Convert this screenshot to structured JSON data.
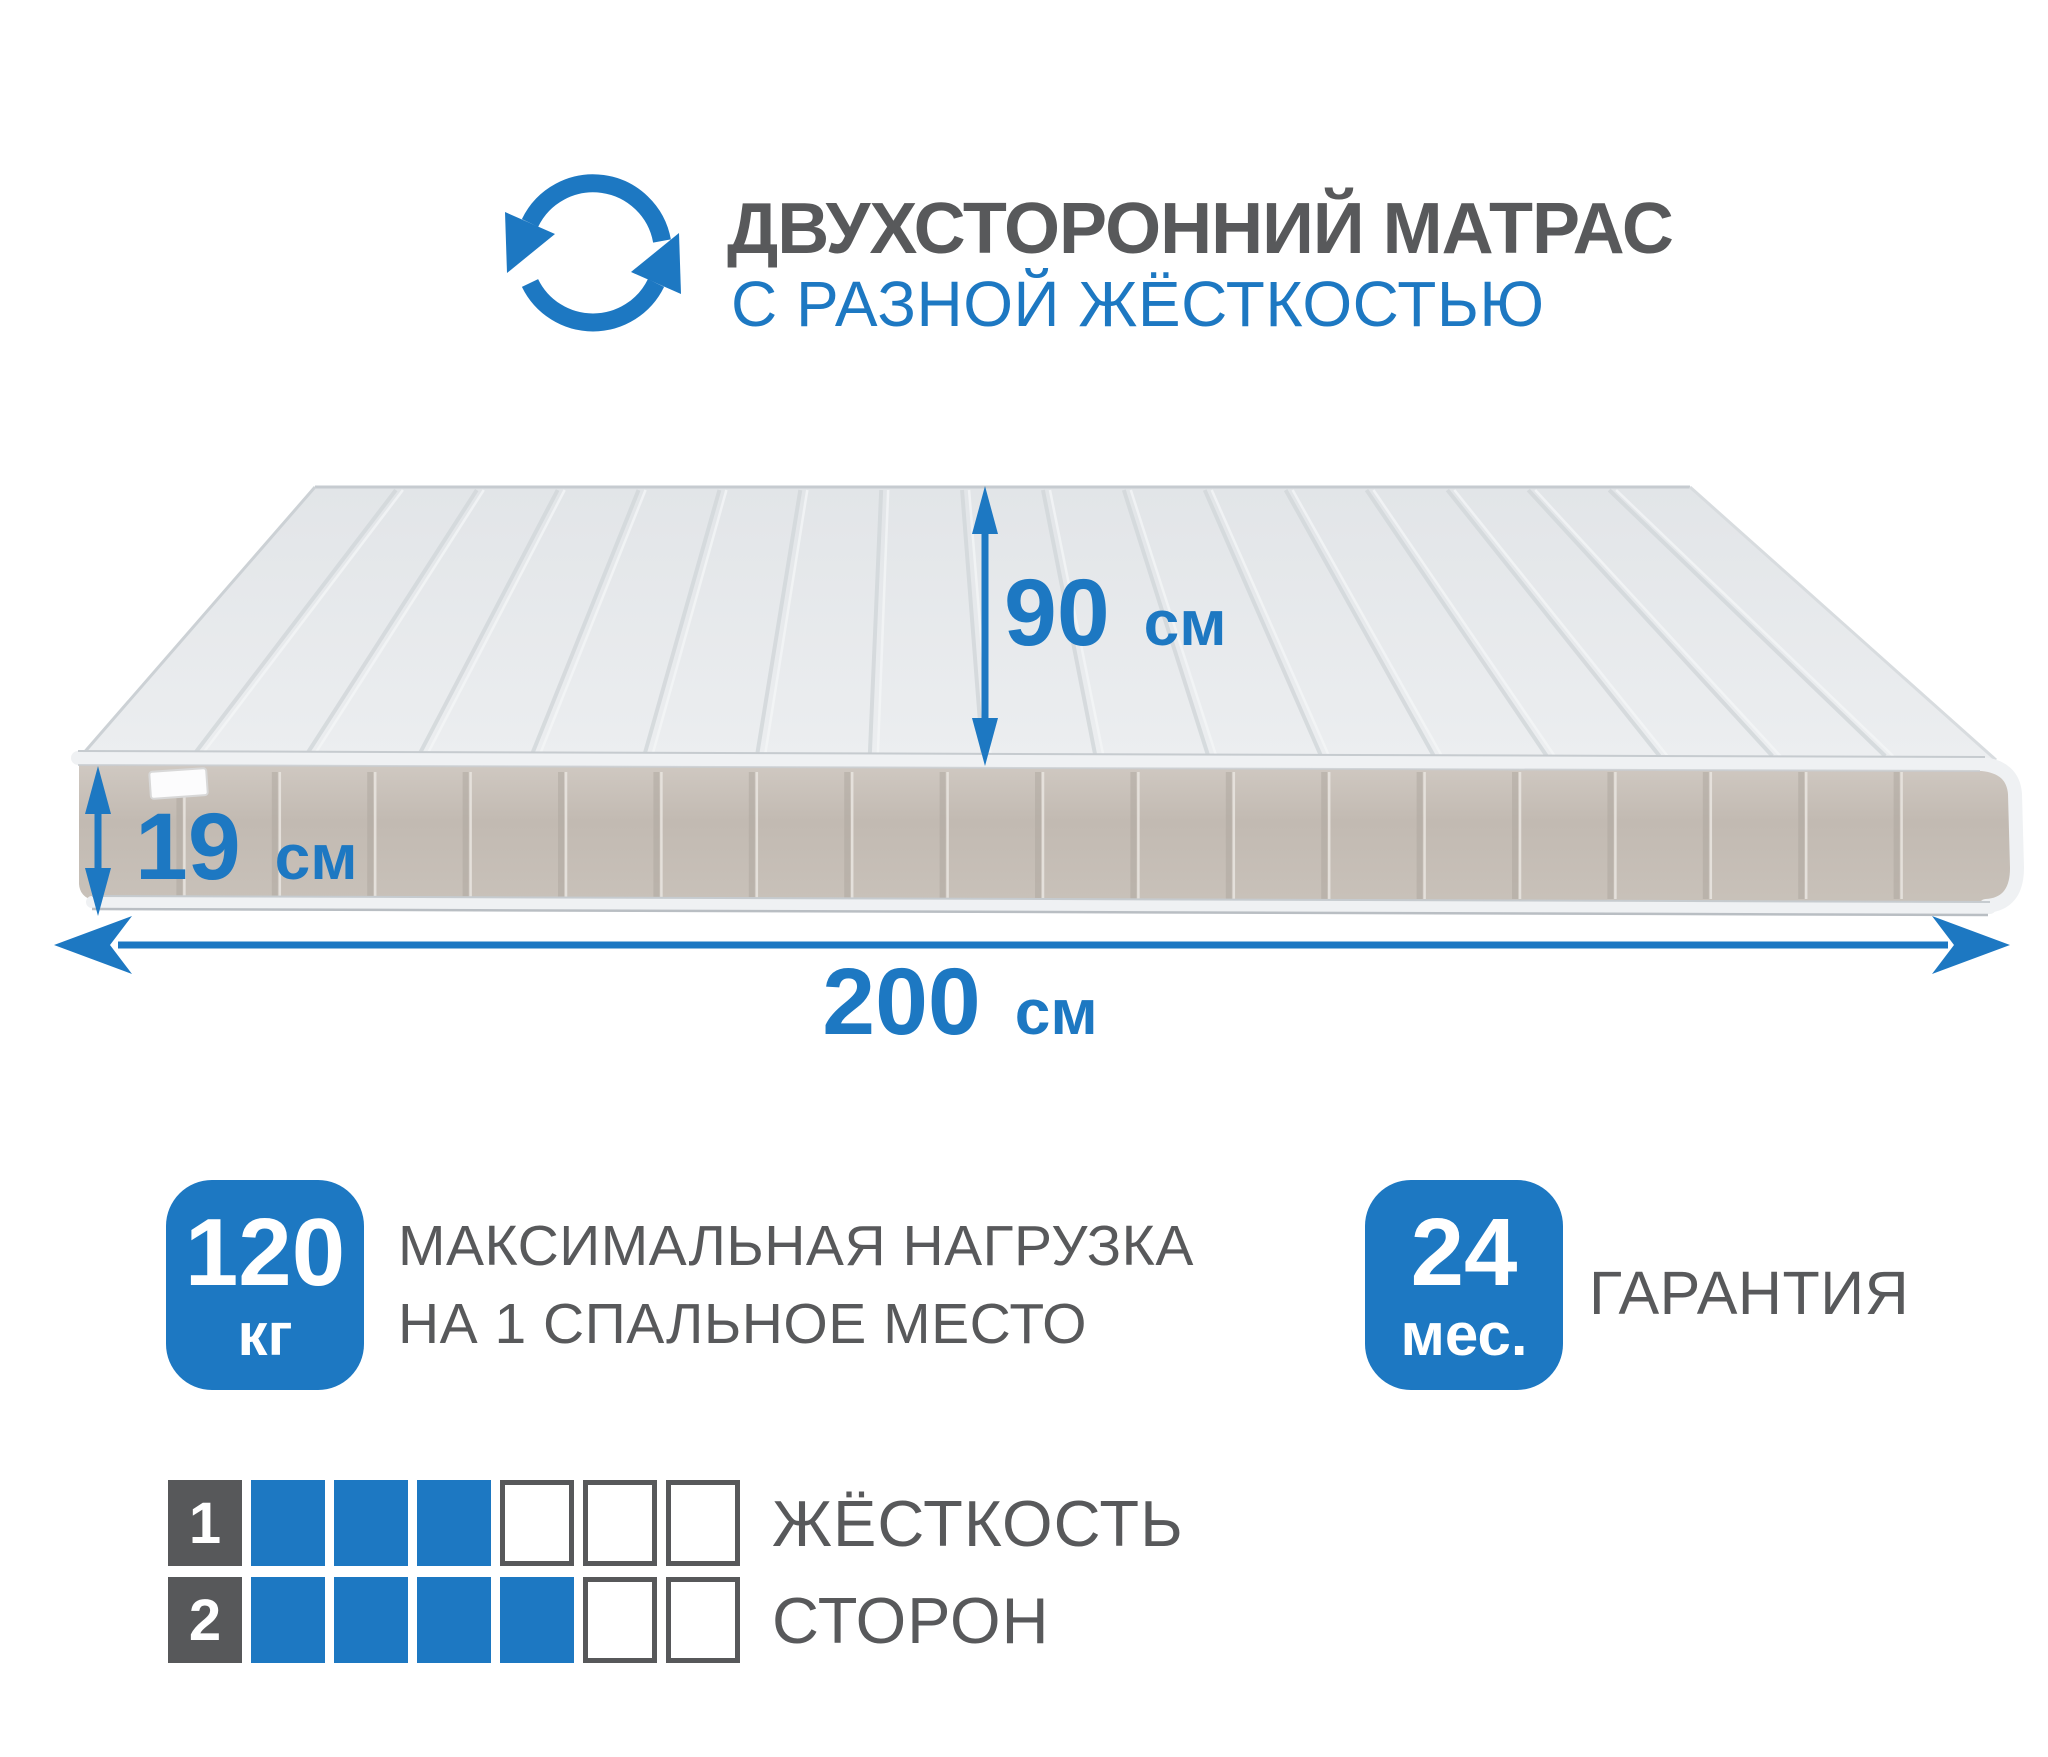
{
  "header": {
    "title": "ДВУХСТОРОННИЙ МАТРАС",
    "subtitle": "С РАЗНОЙ ЖЁСТКОСТЬЮ",
    "icon": "rotate-arrows-icon"
  },
  "colors": {
    "accent_blue": "#1d78c2",
    "text_gray": "#58595b",
    "mattress_top": "#e8ebed",
    "mattress_side": "#c4bcb4",
    "piping_white": "#eff1f3"
  },
  "dimensions": {
    "width": {
      "value": "90",
      "unit": "см"
    },
    "height": {
      "value": "19",
      "unit": "см"
    },
    "length": {
      "value": "200",
      "unit": "см"
    }
  },
  "features": [
    {
      "badge_value": "120",
      "badge_unit": "кг",
      "label_line1": "МАКСИМАЛЬНАЯ НАГРУЗКА",
      "label_line2": "НА 1 СПАЛЬНОЕ МЕСТО"
    },
    {
      "badge_value": "24",
      "badge_unit": "мес.",
      "label_line1": "ГАРАНТИЯ"
    }
  ],
  "firmness_scale": {
    "label_line1": "ЖЁСТКОСТЬ",
    "label_line2": "СТОРОН",
    "rows": [
      {
        "side": "1",
        "filled": 3,
        "total": 6
      },
      {
        "side": "2",
        "filled": 4,
        "total": 6
      }
    ]
  }
}
